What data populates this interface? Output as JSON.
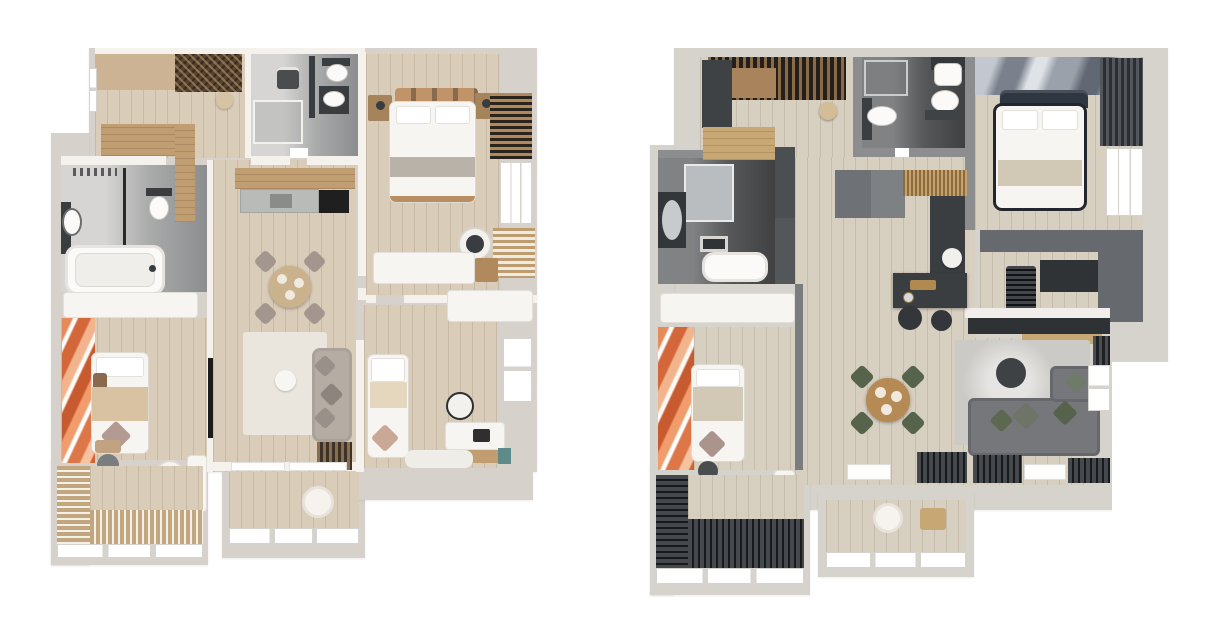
{
  "page": {
    "background": "#ffffff",
    "description": "Two top-down 3D apartment floor plan renderings side by side; no text labels are rendered in the image"
  },
  "plans": [
    {
      "id": "plan-light",
      "name": "Apartment floor plan - light scheme",
      "scheme": "light",
      "colors": {
        "wall": "#d6d1cb",
        "face": "#f5f2ee",
        "floor": "#d9ccb8",
        "wood": "#c19e72",
        "woodPale": "#cbb394",
        "white": "#f7f5f2",
        "rug": "#eae6de",
        "sofa": "#b5aca4",
        "pillow": "#99908a",
        "chair": "#a2968f",
        "tableWood": "#c9b28c",
        "bedTan": "#d9c2a2",
        "darkfix": "#3a3d3f",
        "teal": "#5f8a8a",
        "marble": "#b9bbb8",
        "art": "#d4673a",
        "artHi": "#f2a97d"
      },
      "rooms": [
        {
          "key": "kitchen",
          "label": "Kitchen"
        },
        {
          "key": "bathroom",
          "label": "Bathroom with shower"
        },
        {
          "key": "bedroom-main",
          "label": "Main bedroom"
        },
        {
          "key": "bathroom-tub",
          "label": "Bathroom with bathtub"
        },
        {
          "key": "living-dining",
          "label": "Living and dining room"
        },
        {
          "key": "bedroom-2",
          "label": "Second bedroom"
        },
        {
          "key": "office",
          "label": "Office guest room"
        },
        {
          "key": "balcony-left",
          "label": "Balcony with wood deck"
        },
        {
          "key": "balcony-center",
          "label": "Loggia"
        }
      ],
      "furniture": [
        "kitchen-counter",
        "kitchen-island",
        "dining-table",
        "dining-chair",
        "sofa",
        "tv",
        "area-rug",
        "pouf",
        "double-bed",
        "wardrobe-slats",
        "radiator-slats",
        "washing-machine",
        "toilet",
        "sink",
        "bathtub",
        "shower-glass",
        "papasan-chair",
        "desk",
        "desk-chair",
        "bench-dresser",
        "window",
        "slatted-deck",
        "single-bed",
        "laptop",
        "books",
        "artwork"
      ]
    },
    {
      "id": "plan-dark",
      "name": "Apartment floor plan - dark scheme",
      "scheme": "dark",
      "colors": {
        "wall": "#d6d2cc",
        "face": "#8b8d8f",
        "floor": "#d7cfc0",
        "wood": "#c7a874",
        "woodDeep": "#a8835c",
        "white": "#f7f5f2",
        "rug": "#cbcac6",
        "sofa": "#75777a",
        "pillowGreen": "#5c684f",
        "chair": "#57644c",
        "tableWood": "#b68a55",
        "bedTan": "#d2c8b6",
        "darkfix": "#3b3e41",
        "cabinet": "#6e7276",
        "navy": "#2f3743",
        "marble": "#9aa0a8",
        "art": "#d4673a",
        "artHi": "#f2a97d"
      },
      "rooms": [
        {
          "key": "entry-kitchen",
          "label": "Entry and kitchen"
        },
        {
          "key": "shower-room",
          "label": "Shower room"
        },
        {
          "key": "bedroom-main",
          "label": "Main bedroom"
        },
        {
          "key": "bathroom-tub",
          "label": "Bathroom with bathtub"
        },
        {
          "key": "living-dining",
          "label": "Living and dining room"
        },
        {
          "key": "walk-in-closet",
          "label": "Walk-in closet"
        },
        {
          "key": "bedroom-2",
          "label": "Second bedroom"
        },
        {
          "key": "balcony-left",
          "label": "Balcony with dark deck"
        },
        {
          "key": "balcony-center",
          "label": "Loggia"
        }
      ],
      "furniture": [
        "entry-wardrobe",
        "ceiling-slats",
        "kitchen-counter",
        "kitchen-island",
        "bar-stool",
        "dining-table",
        "dining-chair-green",
        "corner-sofa",
        "coffee-table",
        "area-rug",
        "double-bed",
        "headboard",
        "curtains",
        "clothes-stack",
        "toilet",
        "sink",
        "bathtub",
        "shower-glass",
        "vanity-mirror",
        "papasan-chair",
        "desk",
        "desk-chair",
        "window",
        "slatted-deck",
        "tv-sideboard",
        "artwork"
      ]
    }
  ]
}
